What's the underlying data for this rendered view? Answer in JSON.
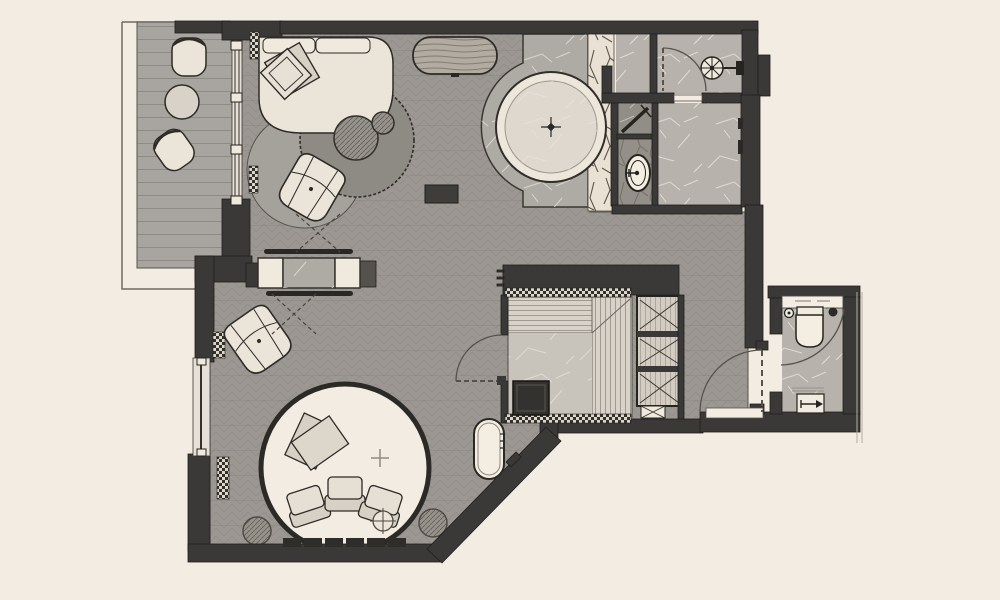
{
  "document": {
    "kind": "architectural-floor-plan",
    "visible_text": ""
  },
  "colors": {
    "bg": "#f3ece2",
    "wall": "#3b3937",
    "wallStroke": "#201e1c",
    "wallLight": "#55514c",
    "floorBase": "#9c9792",
    "floorLine": "#86817b",
    "deck": "#a8a49f",
    "deckLine": "#8b877f",
    "furniture": "#ebe4d9",
    "furnitureLight": "#f0e9dd",
    "furnitureDark": "#d7d0c5",
    "outline": "#2e2b27",
    "marbleLight": "#b7b2ac",
    "marbleMid": "#aeaaa4",
    "marbleDark": "#918d87",
    "vein": "#eae5de",
    "wood": "#b2aba2",
    "woodLine": "#776f64",
    "slat": "#d8d2c9",
    "slatLine": "#7f7a71",
    "saunaFloor": "#c8c3bb",
    "heater": "#343230",
    "rugLight": "#a5a19b",
    "rugDark": "#8e8a84",
    "hatchFill": "#97938c",
    "hatchLine": "#54504a",
    "branch": "#4c463d",
    "branchBg": "#e9e1d4",
    "tubRing": "#ece6db",
    "water": "#ded8cf",
    "fixtureWhite": "#f3ede2",
    "arc": "#57524b",
    "slabLine": "#6f6a63"
  },
  "legend": {
    "regions": [
      "balcony",
      "living-room",
      "media-wall",
      "soaking-tub-platform",
      "botanical-strip",
      "bathroom",
      "shower-stall",
      "wc-stall",
      "fan-room",
      "sauna",
      "wardrobe",
      "corridor",
      "water-closet",
      "conversation-pit"
    ],
    "fixtures": [
      "balcony-chairs",
      "balcony-table",
      "sofa",
      "pillows",
      "coffee-table",
      "area-rugs",
      "poufs",
      "lounge-chairs",
      "tv-console",
      "soaking-tub",
      "ceiling-fan",
      "shower-head",
      "toilets",
      "sauna-heater",
      "sauna-benches",
      "plunge-tub",
      "floor-vent",
      "planters",
      "pit-cushions",
      "door-swings",
      "windows"
    ]
  }
}
